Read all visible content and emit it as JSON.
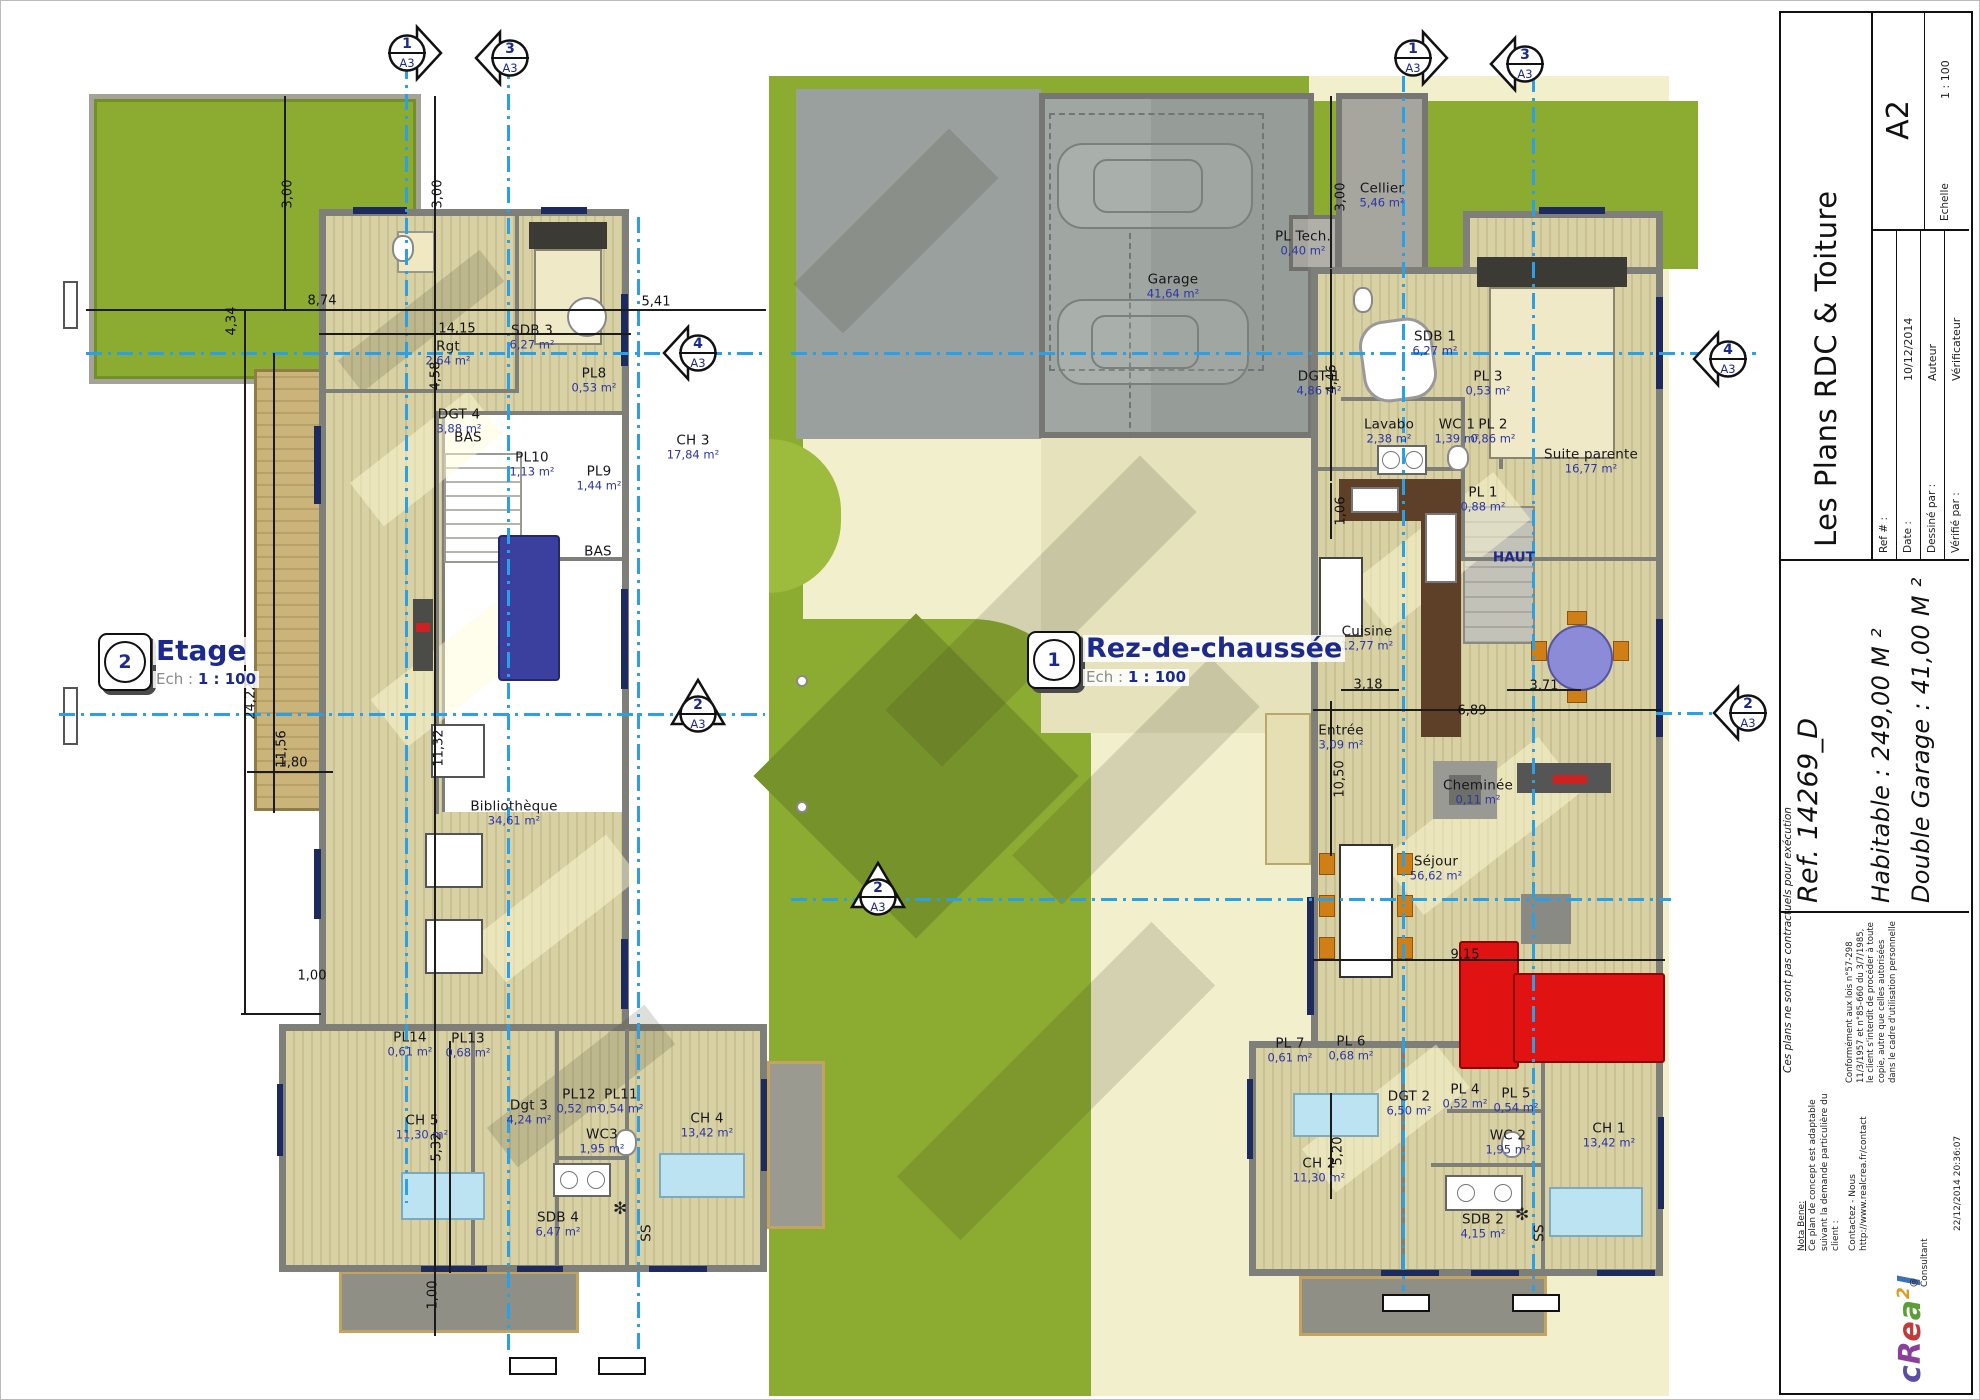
{
  "title_block": {
    "title": "Les Plans RDC & Toiture",
    "fields": [
      {
        "label": "Ref # :",
        "value": ""
      },
      {
        "label": "Date :",
        "value": "10/12/2014"
      },
      {
        "label": "Dessiné par :",
        "value": "Auteur"
      },
      {
        "label": "Vérifié par :",
        "value": "Vérificateur"
      }
    ],
    "scale_label": "Echelle",
    "scale_value": "1 : 100",
    "sheet_format": "A2",
    "ref_line": "Ref. 14269_D",
    "habitable_line": "Habitable : 249,00 M ²",
    "garage_line": "Double Garage : 41,00 M ²",
    "nota_bene_title": "Nota Bene:",
    "nota_bene_body": "Ce plan de concept est adaptable suivant la demande particulière du client :",
    "contact_line": "Contactez - Nous http://www.realcrea.fr/contact",
    "legal_text": "Conformément aux lois n°57-298 11/3/1957 et n°85-660 du 3/7/1985, le client s'interdit de procéder à toute copie, autre que celles autorisées dans le cadre d'utilisation personnelle",
    "consultant": "@ Consultant",
    "disclaimer_side": "Ces plans ne sont pas contractuels pour exécution",
    "timestamp": "22/12/2014 20:36:07",
    "logo_letters": [
      {
        "ch": "c",
        "color": "#5b4ea0",
        "sup": false
      },
      {
        "ch": "R",
        "color": "#8b3f9b",
        "sup": false
      },
      {
        "ch": "e",
        "color": "#c13b3b",
        "sup": false
      },
      {
        "ch": "a",
        "color": "#5a9e35",
        "sup": false
      },
      {
        "ch": "2",
        "color": "#e09a1e",
        "sup": true
      },
      {
        "ch": "l",
        "color": "#3f6fb5",
        "sup": false
      }
    ]
  },
  "plans": [
    {
      "id": "etage",
      "number": "2",
      "name": "Etage",
      "ech_label": "Ech :",
      "scale": "1 : 100",
      "rooms": [
        {
          "name": "SDB 3",
          "area": "6,27 m²",
          "x": 531,
          "y": 336
        },
        {
          "name": "Rgt",
          "area": "2,64 m²",
          "x": 447,
          "y": 352
        },
        {
          "name": "DGT 4",
          "area": "3,88 m²",
          "x": 458,
          "y": 420
        },
        {
          "name": "PL8",
          "area": "0,53 m²",
          "x": 593,
          "y": 379
        },
        {
          "name": "PL10",
          "area": "1,13 m²",
          "x": 531,
          "y": 463
        },
        {
          "name": "PL9",
          "area": "1,44 m²",
          "x": 598,
          "y": 477
        },
        {
          "name": "CH 3",
          "area": "17,84 m²",
          "x": 692,
          "y": 446
        },
        {
          "name": "BAS",
          "x": 467,
          "y": 437
        },
        {
          "name": "BAS",
          "x": 597,
          "y": 551
        },
        {
          "name": "Bibliothèque",
          "area": "34,61 m²",
          "x": 513,
          "y": 812
        },
        {
          "name": "PL14",
          "area": "0,61 m²",
          "x": 409,
          "y": 1043
        },
        {
          "name": "PL13",
          "area": "0,68 m²",
          "x": 467,
          "y": 1044
        },
        {
          "name": "CH 5",
          "area": "11,30 m²",
          "x": 421,
          "y": 1126
        },
        {
          "name": "Dgt 3",
          "area": "4,24 m²",
          "x": 528,
          "y": 1111
        },
        {
          "name": "PL12",
          "area": "0,52 m²",
          "x": 578,
          "y": 1100
        },
        {
          "name": "PL11",
          "area": "0,54 m²",
          "x": 620,
          "y": 1100
        },
        {
          "name": "WC3",
          "area": "1,95 m²",
          "x": 601,
          "y": 1140
        },
        {
          "name": "SDB 4",
          "area": "6,47 m²",
          "x": 557,
          "y": 1223
        },
        {
          "name": "CH 4",
          "area": "13,42 m²",
          "x": 706,
          "y": 1124
        },
        {
          "name": "SS",
          "x": 646,
          "y": 1232,
          "rot": true
        }
      ],
      "dims": [
        {
          "t": "3,00",
          "x": 287,
          "y": 193,
          "rot": true
        },
        {
          "t": "3,00",
          "x": 437,
          "y": 193,
          "rot": true
        },
        {
          "t": "8,74",
          "x": 321,
          "y": 300
        },
        {
          "t": "14,15",
          "x": 456,
          "y": 328
        },
        {
          "t": "4,34",
          "x": 231,
          "y": 320,
          "rot": true
        },
        {
          "t": "4,58",
          "x": 435,
          "y": 375,
          "rot": true
        },
        {
          "t": "5,41",
          "x": 655,
          "y": 301
        },
        {
          "t": "24,22",
          "x": 250,
          "y": 700,
          "rot": true
        },
        {
          "t": "11,56",
          "x": 281,
          "y": 748,
          "rot": true
        },
        {
          "t": "11,32",
          "x": 438,
          "y": 747,
          "rot": true
        },
        {
          "t": "1,80",
          "x": 292,
          "y": 762
        },
        {
          "t": "1,00",
          "x": 311,
          "y": 975
        },
        {
          "t": "5,32",
          "x": 436,
          "y": 1146,
          "rot": true
        },
        {
          "t": "1,00",
          "x": 432,
          "y": 1294,
          "rot": true
        }
      ],
      "markers": [
        {
          "n": "1",
          "p": "A3",
          "x": 406,
          "y": 52,
          "dir": "right"
        },
        {
          "n": "3",
          "p": "A3",
          "x": 509,
          "y": 57,
          "dir": "left"
        },
        {
          "n": "4",
          "p": "A3",
          "x": 697,
          "y": 352,
          "dir": "left"
        },
        {
          "n": "2",
          "p": "A3",
          "x": 697,
          "y": 713,
          "dir": "up"
        }
      ]
    },
    {
      "id": "rdc",
      "number": "1",
      "name": "Rez-de-chaussée",
      "ech_label": "Ech :",
      "scale": "1 : 100",
      "rooms": [
        {
          "name": "Cellier",
          "area": "5,46 m²",
          "x": 1381,
          "y": 194
        },
        {
          "name": "PL Tech.",
          "area": "0,40 m²",
          "x": 1302,
          "y": 242
        },
        {
          "name": "Garage",
          "area": "41,64 m²",
          "x": 1172,
          "y": 285
        },
        {
          "name": "SDB 1",
          "area": "6,27 m²",
          "x": 1434,
          "y": 342
        },
        {
          "name": "DGT 1",
          "area": "4,86 m²",
          "x": 1318,
          "y": 382
        },
        {
          "name": "PL 3",
          "area": "0,53 m²",
          "x": 1487,
          "y": 382
        },
        {
          "name": "Lavabo",
          "area": "2,38 m²",
          "x": 1388,
          "y": 430
        },
        {
          "name": "WC 1",
          "area": "1,39 m²",
          "x": 1456,
          "y": 430
        },
        {
          "name": "PL 2",
          "area": "0,86 m²",
          "x": 1492,
          "y": 430
        },
        {
          "name": "Suite parente",
          "area": "16,77 m²",
          "x": 1590,
          "y": 460
        },
        {
          "name": "PL 1",
          "area": "0,88 m²",
          "x": 1482,
          "y": 498
        },
        {
          "name": "HAUT",
          "x": 1513,
          "y": 557,
          "cls": "blue"
        },
        {
          "name": "Cuisine",
          "area": "12,77 m²",
          "x": 1366,
          "y": 637
        },
        {
          "name": "Entrée",
          "area": "3,09 m²",
          "x": 1340,
          "y": 736
        },
        {
          "name": "Cheminée",
          "area": "0,11 m²",
          "x": 1477,
          "y": 791
        },
        {
          "name": "Séjour",
          "area": "56,62 m²",
          "x": 1435,
          "y": 867
        },
        {
          "name": "PL 7",
          "area": "0,61 m²",
          "x": 1289,
          "y": 1049
        },
        {
          "name": "PL 6",
          "area": "0,68 m²",
          "x": 1350,
          "y": 1047
        },
        {
          "name": "DGT 2",
          "area": "6,50 m²",
          "x": 1408,
          "y": 1102
        },
        {
          "name": "PL 4",
          "area": "0,52 m²",
          "x": 1464,
          "y": 1095
        },
        {
          "name": "PL 5",
          "area": "0,54 m²",
          "x": 1515,
          "y": 1099
        },
        {
          "name": "WC 2",
          "area": "1,95 m²",
          "x": 1507,
          "y": 1141
        },
        {
          "name": "CH 2",
          "area": "11,30 m²",
          "x": 1318,
          "y": 1169
        },
        {
          "name": "CH 1",
          "area": "13,42 m²",
          "x": 1608,
          "y": 1134
        },
        {
          "name": "SDB 2",
          "area": "4,15 m²",
          "x": 1482,
          "y": 1225
        },
        {
          "name": "SS",
          "x": 1539,
          "y": 1232,
          "rot": true
        }
      ],
      "dims": [
        {
          "t": "3,00",
          "x": 1340,
          "y": 196,
          "rot": true
        },
        {
          "t": "4,46",
          "x": 1331,
          "y": 378,
          "rot": true
        },
        {
          "t": "1,06",
          "x": 1340,
          "y": 510,
          "rot": true
        },
        {
          "t": "3,18",
          "x": 1367,
          "y": 684
        },
        {
          "t": "6,89",
          "x": 1471,
          "y": 710
        },
        {
          "t": "3,71",
          "x": 1543,
          "y": 685
        },
        {
          "t": "10,50",
          "x": 1339,
          "y": 778,
          "rot": true
        },
        {
          "t": "9,15",
          "x": 1464,
          "y": 954
        },
        {
          "t": "5,20",
          "x": 1337,
          "y": 1150,
          "rot": true
        }
      ],
      "markers": [
        {
          "n": "1",
          "p": "A3",
          "x": 1412,
          "y": 57,
          "dir": "right"
        },
        {
          "n": "3",
          "p": "A3",
          "x": 1524,
          "y": 63,
          "dir": "left"
        },
        {
          "n": "4",
          "p": "A3",
          "x": 1727,
          "y": 358,
          "dir": "left"
        },
        {
          "n": "2",
          "p": "A3",
          "x": 877,
          "y": 896,
          "dir": "up"
        },
        {
          "n": "2",
          "p": "A3",
          "x": 1747,
          "y": 712,
          "dir": "left"
        }
      ]
    }
  ]
}
